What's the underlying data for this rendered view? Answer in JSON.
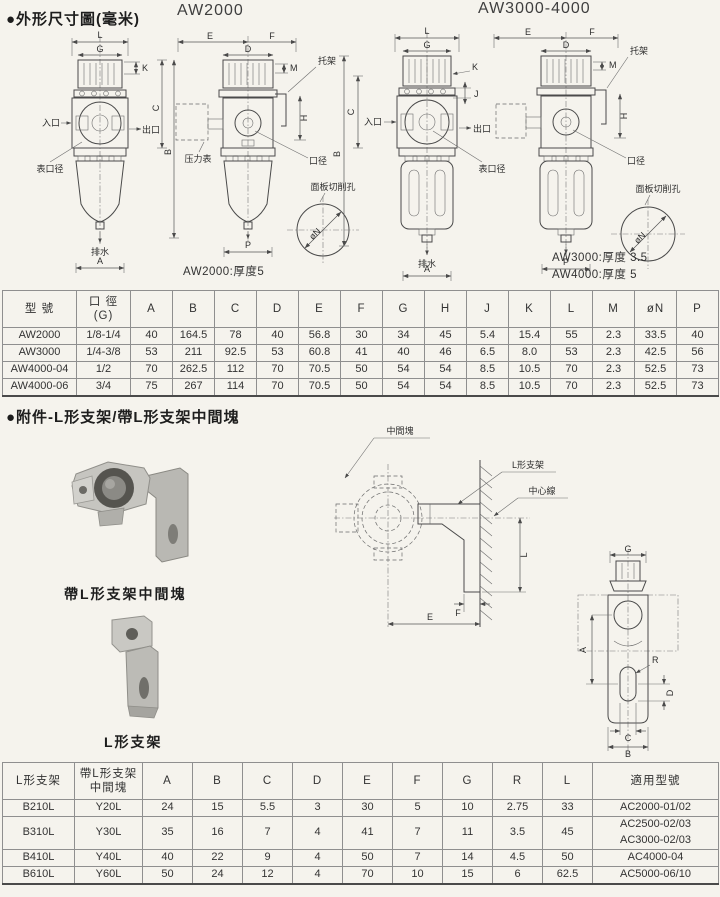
{
  "section_dims": {
    "heading": "●外形尺寸圖(毫米)",
    "model_left": "AW2000",
    "model_right": "AW3000-4000",
    "labels": {
      "inlet": "入口",
      "outlet": "出口",
      "gauge_port": "表口径",
      "pressure_gauge": "压力表",
      "port": "口径",
      "bracket": "托架",
      "drain": "排水",
      "panel_cutout": "面板切削孔",
      "phiN": "øN"
    },
    "dims": {
      "A": "A",
      "B": "B",
      "C": "C",
      "D": "D",
      "E": "E",
      "F": "F",
      "G": "G",
      "H": "H",
      "J": "J",
      "K": "K",
      "L": "L",
      "M": "M",
      "P": "P"
    },
    "note_aw2000": "AW2000:厚度5",
    "note_aw3000": "AW3000:厚度 3.5",
    "note_aw4000": "AW4000:厚度 5"
  },
  "table1": {
    "headers": [
      "型 號",
      "口 徑\n(G)",
      "A",
      "B",
      "C",
      "D",
      "E",
      "F",
      "G",
      "H",
      "J",
      "K",
      "L",
      "M",
      "øN",
      "P"
    ],
    "col_widths": [
      74,
      54,
      42,
      42,
      42,
      42,
      42,
      42,
      42,
      42,
      42,
      42,
      42,
      42,
      42,
      42
    ],
    "rows": [
      [
        "AW2000",
        "1/8-1/4",
        "40",
        "164.5",
        "78",
        "40",
        "56.8",
        "30",
        "34",
        "45",
        "5.4",
        "15.4",
        "55",
        "2.3",
        "33.5",
        "40"
      ],
      [
        "AW3000",
        "1/4-3/8",
        "53",
        "211",
        "92.5",
        "53",
        "60.8",
        "41",
        "40",
        "46",
        "6.5",
        "8.0",
        "53",
        "2.3",
        "42.5",
        "56"
      ],
      [
        "AW4000-04",
        "1/2",
        "70",
        "262.5",
        "112",
        "70",
        "70.5",
        "50",
        "54",
        "54",
        "8.5",
        "10.5",
        "70",
        "2.3",
        "52.5",
        "73"
      ],
      [
        "AW4000-06",
        "3/4",
        "75",
        "267",
        "114",
        "70",
        "70.5",
        "50",
        "54",
        "54",
        "8.5",
        "10.5",
        "70",
        "2.3",
        "52.5",
        "73"
      ]
    ]
  },
  "section_bracket": {
    "heading": "●附件-L形支架/帶L形支架中間塊",
    "caption_block": "帶L形支架中間塊",
    "caption_bracket": "L形支架",
    "labels": {
      "middle_block": "中間塊",
      "l_bracket": "L形支架",
      "center_line": "中心線"
    },
    "dims": {
      "A": "A",
      "B": "B",
      "C": "C",
      "D": "D",
      "E": "E",
      "F": "F",
      "G": "G",
      "L": "L",
      "R": "R"
    }
  },
  "table2": {
    "headers": [
      "L形支架",
      "帶L形支架\n中間塊",
      "A",
      "B",
      "C",
      "D",
      "E",
      "F",
      "G",
      "R",
      "L",
      "適用型號"
    ],
    "col_widths": [
      72,
      68,
      50,
      50,
      50,
      50,
      50,
      50,
      50,
      50,
      50,
      126
    ],
    "rows": [
      [
        "B210L",
        "Y20L",
        "24",
        "15",
        "5.5",
        "3",
        "30",
        "5",
        "10",
        "2.75",
        "33",
        "AC2000-01/02"
      ],
      [
        "B310L",
        "Y30L",
        "35",
        "16",
        "7",
        "4",
        "41",
        "7",
        "11",
        "3.5",
        "45",
        "AC2500-02/03\nAC3000-02/03"
      ],
      [
        "B410L",
        "Y40L",
        "40",
        "22",
        "9",
        "4",
        "50",
        "7",
        "14",
        "4.5",
        "50",
        "AC4000-04"
      ],
      [
        "B610L",
        "Y60L",
        "50",
        "24",
        "12",
        "4",
        "70",
        "10",
        "15",
        "6",
        "62.5",
        "AC5000-06/10"
      ]
    ]
  }
}
